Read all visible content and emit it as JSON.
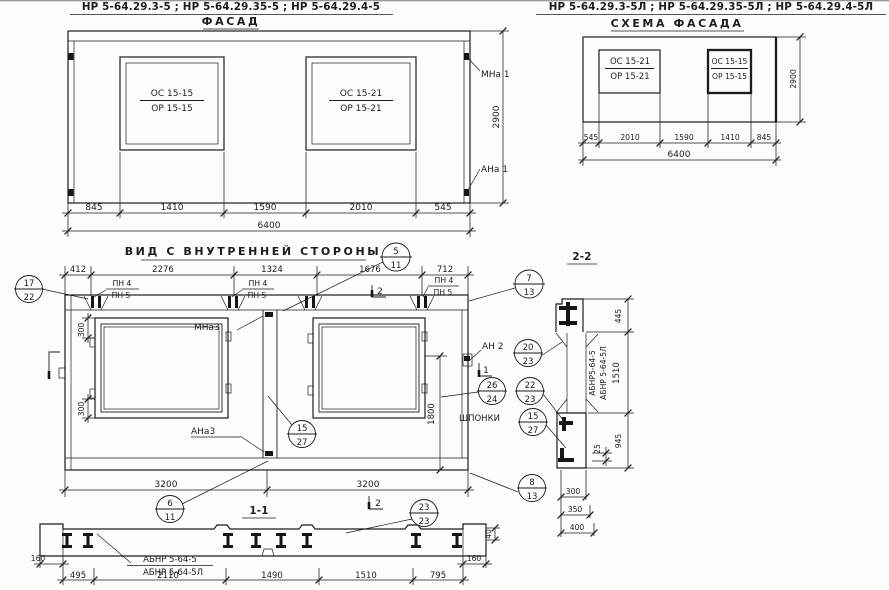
{
  "colors": {
    "ink": "#1c1c1c",
    "paper": "#fdfdfb"
  },
  "facade": {
    "header": "НР 5-64.29.3-5 ;  НР 5-64.29.35-5 ;  НР 5-64.29.4-5",
    "title": "ФАСАД",
    "win_left_top": "ОС 15-15",
    "win_left_bot": "ОР 15-15",
    "win_right_top": "ОС 15-21",
    "win_right_bot": "ОР 15-21",
    "label_mna": "МНа 1",
    "label_ana": "АНа 1",
    "dim_height": "2900",
    "dims": [
      "845",
      "1410",
      "1590",
      "2010",
      "545"
    ],
    "total": "6400"
  },
  "schema": {
    "header": "НР 5-64.29.3-5Л ;  НР 5-64.29.35-5Л ;  НР 5-64.29.4-5Л",
    "title": "СХЕМА ФАСАДА",
    "win_left_top": "ОС 15-21",
    "win_left_bot": "ОР 15-21",
    "win_right_top": "ОС 15-15",
    "win_right_bot": "ОР 15-15",
    "dim_height": "2900",
    "dims": [
      "545",
      "2010",
      "1590",
      "1410",
      "845"
    ],
    "total": "6400"
  },
  "inner": {
    "title": "ВИД С ВНУТРЕННЕЙ СТОРОНЫ",
    "dims_top": [
      "412",
      "2276",
      "1324",
      "1676",
      "712"
    ],
    "pn4": "ПН 4",
    "pn5": "ПН 5",
    "label_mna3": "МНа3",
    "label_ana3": "АНа3",
    "label_an2": "АН 2",
    "shponki": "ШПОНКИ",
    "dim_300": "300",
    "dim_1800": "1800",
    "dims_bottom": [
      "3200",
      "3200"
    ],
    "flag_1": "1",
    "flag_2": "2"
  },
  "sec22": {
    "title": "2-2",
    "label_a": "АБНР5-64-5",
    "label_b": "АБНР 5-64-5Л",
    "d445": "445",
    "d1510": "1510",
    "d945": "945",
    "d25": "25",
    "d300": "300",
    "d350": "350",
    "d400": "400"
  },
  "sec11": {
    "title": "1-1",
    "label_a": "АБНР 5-64-5",
    "label_b": "АБНР 5-64-5Л",
    "dims": [
      "495",
      "2110",
      "1490",
      "1510",
      "795"
    ],
    "d160": "160",
    "d40": "40"
  },
  "callouts": {
    "k5_11": {
      "t": "5",
      "b": "11"
    },
    "k17_22": {
      "t": "17",
      "b": "22"
    },
    "k7_13": {
      "t": "7",
      "b": "13"
    },
    "k20_23": {
      "t": "20",
      "b": "23"
    },
    "k26_24": {
      "t": "26",
      "b": "24"
    },
    "k22_23": {
      "t": "22",
      "b": "23"
    },
    "k15_27": {
      "t": "15",
      "b": "27"
    },
    "k15_27b": {
      "t": "15",
      "b": "27"
    },
    "k6_11": {
      "t": "6",
      "b": "11"
    },
    "k23_23": {
      "t": "23",
      "b": "23"
    },
    "k8_13": {
      "t": "8",
      "b": "13"
    }
  }
}
